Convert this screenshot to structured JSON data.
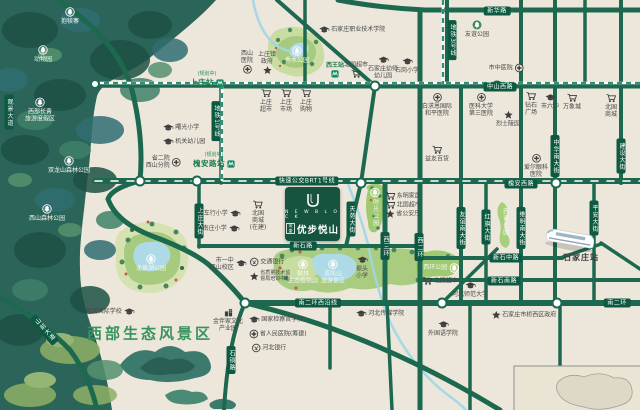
{
  "project": {
    "name_en": "N E W  B L O C K",
    "name_cn": "优步悦山",
    "brand": "荣盛",
    "logo_letter": "U"
  },
  "region": {
    "scenic_area_label": "西部生态风景区"
  },
  "palette": {
    "background": "#ece7da",
    "road_green": "#1d6950",
    "pill_green": "#0d5941",
    "forest_base": "#2b6458",
    "park_green": "#a9cc80",
    "lake_blue": "#aedae8",
    "metro_dash": "#2f8f77",
    "accent_green": "#38925e",
    "logo_card": "#17543f"
  },
  "roads": {
    "labels": [
      {
        "t": "新华路",
        "x": 497,
        "y": 11
      },
      {
        "t": "中山西路",
        "x": 500,
        "y": 87
      },
      {
        "t": "快速公交BRT1号线",
        "x": 307,
        "y": 181
      },
      {
        "t": "槐安西路",
        "x": 521,
        "y": 184
      },
      {
        "t": "新石路",
        "x": 303,
        "y": 246
      },
      {
        "t": "新石中路",
        "x": 506,
        "y": 258
      },
      {
        "t": "新石南路",
        "x": 504,
        "y": 281
      },
      {
        "t": "南二环西沿线",
        "x": 318,
        "y": 303
      },
      {
        "t": "南二环",
        "x": 617,
        "y": 303
      },
      {
        "t": "上庄大街",
        "x": 199,
        "y": 221,
        "v": 1
      },
      {
        "t": "天苑大街",
        "x": 351,
        "y": 219,
        "v": 1
      },
      {
        "t": "西三环",
        "x": 385,
        "y": 246,
        "v": 1
      },
      {
        "t": "西二环",
        "x": 419,
        "y": 247,
        "v": 1
      },
      {
        "t": "友谊南大街",
        "x": 461,
        "y": 228,
        "v": 1
      },
      {
        "t": "红旗大街",
        "x": 486,
        "y": 227,
        "v": 1
      },
      {
        "t": "维明南大街",
        "x": 521,
        "y": 228,
        "v": 1
      },
      {
        "t": "平安大街",
        "x": 594,
        "y": 218,
        "v": 1
      },
      {
        "t": "中华南大街",
        "x": 555,
        "y": 156,
        "v": 1
      },
      {
        "t": "建设大街",
        "x": 621,
        "y": 156,
        "v": 1
      },
      {
        "t": "地铁1号线",
        "x": 216,
        "y": 121,
        "v": 1
      },
      {
        "t": "地铁3号线",
        "x": 452,
        "y": 40,
        "v": 1
      },
      {
        "t": "山前大道",
        "x": 44,
        "y": 330,
        "v": 1,
        "r": -42
      },
      {
        "t": "石铜路",
        "x": 231,
        "y": 360,
        "v": 1
      },
      {
        "t": "观景大道",
        "x": 9,
        "y": 112,
        "v": 1
      }
    ]
  },
  "metro": {
    "stations": [
      {
        "name": "上庄站",
        "status": "(规划中)",
        "x": 207,
        "y": 80
      },
      {
        "name": "槐安路站",
        "status": "(规划中)",
        "x": 214,
        "y": 161
      }
    ]
  },
  "pois": [
    {
      "t": "抱犊寨",
      "ic": "ringtree",
      "pos": "t",
      "cls": "wh",
      "x": 70,
      "y": 16
    },
    {
      "t": "动物园",
      "ic": "ringtree",
      "pos": "t",
      "cls": "wh",
      "x": 43,
      "y": 54
    },
    {
      "t": "西部长青\n旅游度假区",
      "ic": "ringtree",
      "pos": "t",
      "cls": "wh",
      "x": 40,
      "y": 110
    },
    {
      "t": "双龙山森林公园",
      "ic": "ringtree",
      "pos": "t",
      "cls": "wh",
      "x": 69,
      "y": 165
    },
    {
      "t": "西山森林公园",
      "ic": "ringtree",
      "pos": "t",
      "cls": "wh",
      "x": 47,
      "y": 213
    },
    {
      "t": "秀水公园",
      "ic": "ringtree",
      "pos": "t",
      "cls": "wh",
      "x": 297,
      "y": 55
    },
    {
      "t": "龙泉湖公园",
      "ic": "ringtree",
      "pos": "t",
      "cls": "wh",
      "x": 151,
      "y": 263
    },
    {
      "t": "枫林\n生态植物园",
      "ic": "ringtree",
      "pos": "t",
      "cls": "wh",
      "x": 303,
      "y": 272
    },
    {
      "t": "双凤山\n旅游景区",
      "ic": "ringtree",
      "pos": "t",
      "cls": "wh",
      "x": 333,
      "y": 272
    },
    {
      "t": "西环公园",
      "ic": "ringtree",
      "pos": "r",
      "cls": "wh",
      "x": 441,
      "y": 268
    },
    {
      "t": "时光公园",
      "ic": "ringtree",
      "pos": "t",
      "cls": "wh vlab",
      "x": 375,
      "y": 207
    },
    {
      "t": "西青公园",
      "cls": "wh vlab",
      "x": 505,
      "y": 222
    },
    {
      "t": "石家庄职业技术学院",
      "ic": "school",
      "pos": "l",
      "x": 352,
      "y": 30
    },
    {
      "t": "西山\n医院",
      "ic": "hosp",
      "pos": "b",
      "x": 247,
      "y": 62
    },
    {
      "t": "上庄镇\n政府",
      "ic": "star",
      "pos": "b",
      "x": 267,
      "y": 63
    },
    {
      "t": "西王站",
      "ic": "metro",
      "pos": "b",
      "cls": "grn",
      "x": 335,
      "y": 70
    },
    {
      "t": "北国超市",
      "ic": "cart",
      "pos": "b",
      "x": 356,
      "y": 70
    },
    {
      "t": "石家庄幼师\n幼儿园",
      "ic": "school",
      "pos": "t",
      "x": 383,
      "y": 68
    },
    {
      "t": "石岗小学",
      "ic": "school",
      "pos": "t",
      "x": 407,
      "y": 66
    },
    {
      "t": "上庄\n超市",
      "ic": "cart",
      "pos": "t",
      "x": 266,
      "y": 101
    },
    {
      "t": "上庄\n市场",
      "ic": "cart",
      "pos": "t",
      "x": 286,
      "y": 101
    },
    {
      "t": "上庄\n购物",
      "ic": "cart",
      "pos": "t",
      "x": 306,
      "y": 101
    },
    {
      "t": "曙光小学",
      "ic": "school",
      "pos": "l",
      "x": 181,
      "y": 128
    },
    {
      "t": "机关幼儿园",
      "ic": "school",
      "pos": "l",
      "x": 184,
      "y": 142
    },
    {
      "t": "省二院\n西山分院",
      "ic": "hosp",
      "pos": "r",
      "x": 163,
      "y": 162
    },
    {
      "t": "大车行小学",
      "ic": "school",
      "pos": "r",
      "x": 219,
      "y": 214
    },
    {
      "t": "南庄小学",
      "ic": "school",
      "pos": "r",
      "x": 221,
      "y": 229
    },
    {
      "t": "北国\n商城\n(在建)",
      "ic": "cart",
      "pos": "t",
      "x": 258,
      "y": 216
    },
    {
      "t": "市一中\n西山校区",
      "ic": "school",
      "pos": "r",
      "x": 228,
      "y": 264
    },
    {
      "t": "交通银行",
      "ic": "bank",
      "pos": "l",
      "x": 267,
      "y": 262
    },
    {
      "t": "省质量技术监\n督局培训中心",
      "ic": "star",
      "pos": "l",
      "cls": "tiny",
      "x": 270,
      "y": 276
    },
    {
      "t": "振头\n小学",
      "ic": "school",
      "pos": "t",
      "x": 362,
      "y": 268
    },
    {
      "t": "东明家居",
      "ic": "cart",
      "pos": "l",
      "x": 403,
      "y": 196
    },
    {
      "t": "北国超市",
      "ic": "cart",
      "pos": "l",
      "x": 403,
      "y": 205
    },
    {
      "t": "省公安厅",
      "ic": "star",
      "pos": "l",
      "x": 403,
      "y": 214
    },
    {
      "t": "白求恩国际\n和平医院",
      "ic": "hosp",
      "pos": "t",
      "x": 437,
      "y": 105
    },
    {
      "t": "医科大学\n第三医院",
      "ic": "hosp",
      "pos": "t",
      "x": 481,
      "y": 105
    },
    {
      "t": "烈士陵园",
      "ic": "star",
      "pos": "t",
      "x": 508,
      "y": 119
    },
    {
      "t": "钻石\n广场",
      "ic": "cart",
      "pos": "t",
      "x": 531,
      "y": 104
    },
    {
      "t": "市六中",
      "ic": "school",
      "pos": "t",
      "x": 550,
      "y": 102
    },
    {
      "t": "万象城",
      "ic": "cart",
      "pos": "t",
      "x": 572,
      "y": 102
    },
    {
      "t": "北国\n商城",
      "ic": "cart",
      "pos": "t",
      "x": 611,
      "y": 106
    },
    {
      "t": "益友百货",
      "ic": "cart",
      "pos": "t",
      "x": 437,
      "y": 154
    },
    {
      "t": "市中医院",
      "ic": "hosp",
      "pos": "r",
      "x": 506,
      "y": 68
    },
    {
      "t": "爱尔眼科\n医院",
      "ic": "hosp",
      "pos": "t",
      "x": 536,
      "y": 166
    },
    {
      "t": "友谊公园",
      "ic": "greentree",
      "pos": "t",
      "x": 477,
      "y": 29
    },
    {
      "t": "河北师范大学",
      "ic": "school",
      "pos": "t",
      "x": 470,
      "y": 290
    },
    {
      "t": "石家庄市桥西区政府",
      "ic": "star",
      "pos": "l",
      "x": 524,
      "y": 315
    },
    {
      "t": "外国语学院",
      "ic": "school",
      "pos": "t",
      "x": 443,
      "y": 329
    },
    {
      "t": "北国超市",
      "ic": "cart",
      "pos": "l",
      "x": 440,
      "y": 281
    },
    {
      "t": "河北传媒学院",
      "ic": "school",
      "pos": "l",
      "x": 380,
      "y": 314
    },
    {
      "t": "国家检察官学院",
      "ic": "school",
      "pos": "l",
      "x": 276,
      "y": 320
    },
    {
      "t": "省人民医院(筹建)",
      "ic": "hosp",
      "pos": "l",
      "x": 278,
      "y": 334
    },
    {
      "t": "河北银行",
      "ic": "bank",
      "pos": "l",
      "x": 269,
      "y": 348
    },
    {
      "t": "金伴家文化\n产业园",
      "ic": "bldg",
      "pos": "t",
      "x": 228,
      "y": 320
    },
    {
      "t": "蓝湾国际学校",
      "ic": "school",
      "pos": "r",
      "x": 110,
      "y": 312
    },
    {
      "t": "石家庄站",
      "cls": "stn",
      "x": 581,
      "y": 258
    }
  ]
}
